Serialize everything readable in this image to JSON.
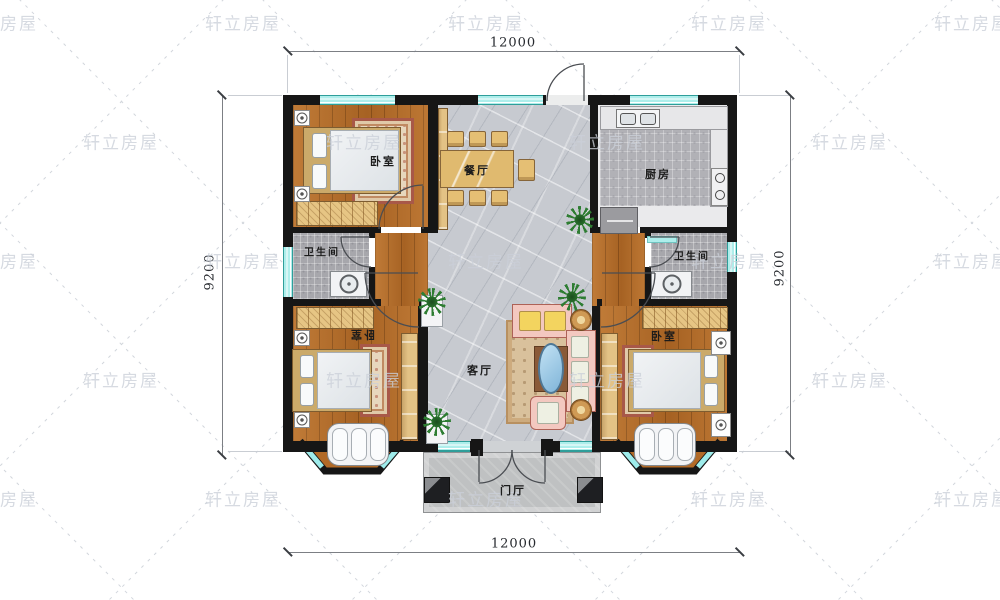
{
  "watermark": {
    "text": "轩立房屋"
  },
  "dimensions": {
    "top": "12000",
    "bottom": "12000",
    "left": "9200",
    "right": "9200"
  },
  "rooms": {
    "bedroom_tl": "卧室",
    "dining": "餐厅",
    "kitchen": "厨房",
    "bath_left": "卫生间",
    "bath_right": "卫生间",
    "bedroom_bl": "卧室",
    "living": "客厅",
    "bedroom_br": "卧室",
    "foyer": "门厅"
  },
  "colors": {
    "wall": "#161616",
    "window": "#aeeeeb",
    "wood_floor": "#b26a27",
    "marble_floor": "#c7cad0",
    "furniture_tan": "#e6c584",
    "watermark": "#cbd0d8"
  }
}
